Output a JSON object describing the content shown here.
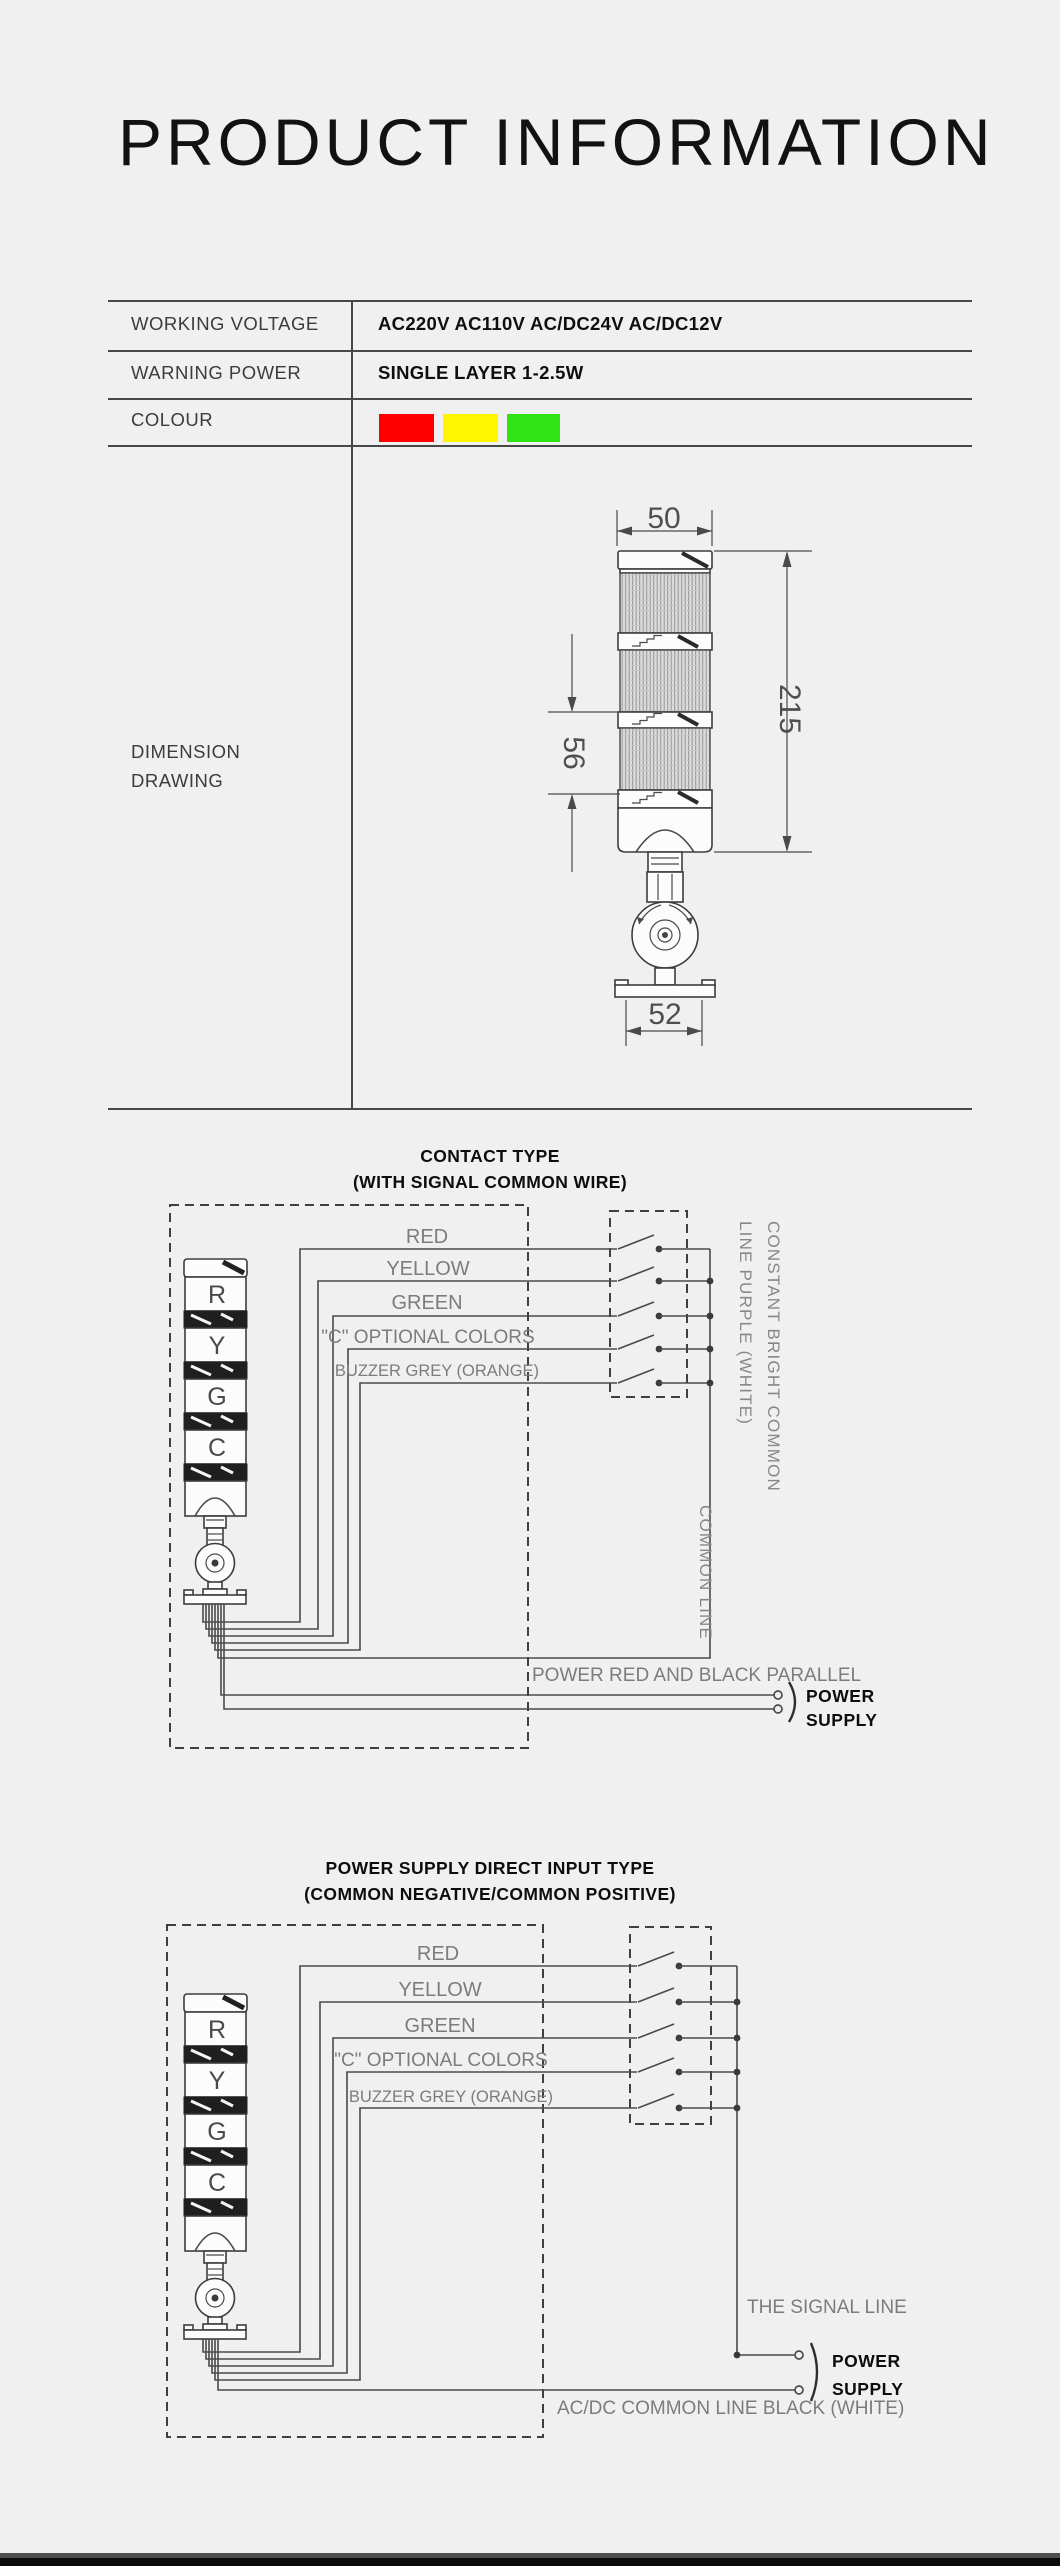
{
  "page": {
    "title": "PRODUCT INFORMATION"
  },
  "colors": {
    "background": "#f0f0f0",
    "line": "#4a4a4a",
    "label_grey": "#7c7c7c",
    "swatch_red": "#ff0000",
    "swatch_yellow": "#fff500",
    "swatch_green": "#30e413"
  },
  "spec_table": {
    "rows": [
      {
        "label": "WORKING VOLTAGE",
        "value": "AC220V AC110V AC/DC24V AC/DC12V"
      },
      {
        "label": "WARNING POWER",
        "value": "SINGLE LAYER 1-2.5W"
      },
      {
        "label": "COLOUR"
      }
    ],
    "dimension_row": {
      "line1": "DIMENSION",
      "line2": "DRAWING"
    }
  },
  "dimension_drawing": {
    "width_top": "50",
    "height_total": "215",
    "lens_height": "56",
    "base_width": "52"
  },
  "tower": {
    "labels": [
      "R",
      "Y",
      "G",
      "C"
    ]
  },
  "diagram1": {
    "title_line1": "CONTACT TYPE",
    "title_line2": "(WITH SIGNAL COMMON WIRE)",
    "wires": [
      "RED",
      "YELLOW",
      "GREEN",
      "\"C\" OPTIONAL COLORS",
      "BUZZER GREY (ORANGE)"
    ],
    "right_text_outer": "CONSTANT BRIGHT COMMON",
    "right_text_inner": "LINE PURPLE (WHITE)",
    "common_line_text": "COMMON LINE",
    "bottom_note": "POWER RED AND BLACK PARALLEL",
    "power_line1": "POWER",
    "power_line2": "SUPPLY"
  },
  "diagram2": {
    "title_line1": "POWER SUPPLY DIRECT INPUT TYPE",
    "title_line2": "(COMMON NEGATIVE/COMMON POSITIVE)",
    "wires": [
      "RED",
      "YELLOW",
      "GREEN",
      "\"C\" OPTIONAL COLORS",
      "BUZZER GREY (ORANGE)"
    ],
    "signal_line_text": "THE SIGNAL LINE",
    "bottom_note": "AC/DC COMMON LINE BLACK (WHITE)",
    "power_line1": "POWER",
    "power_line2": "SUPPLY"
  }
}
